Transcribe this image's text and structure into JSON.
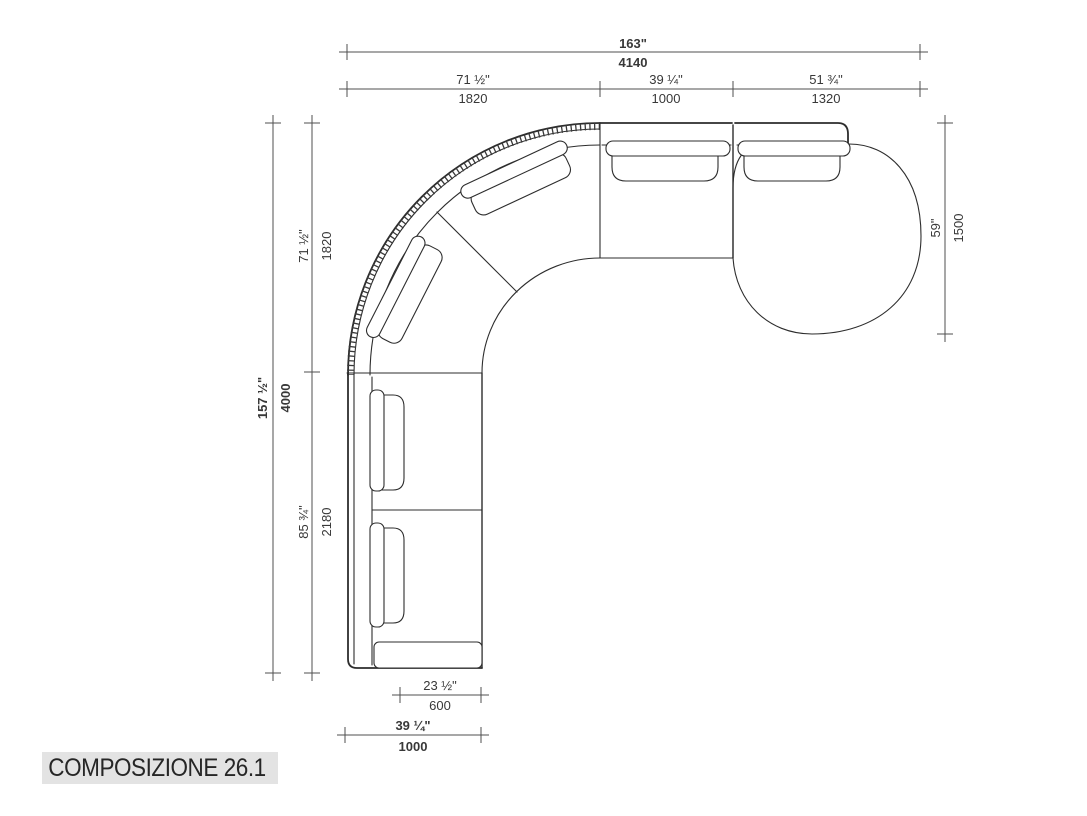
{
  "page": {
    "background": "#ffffff"
  },
  "drawing": {
    "subject": "curved modular sofa plan view",
    "line_color": "#2d2d2d",
    "dim_color": "#4f4f4f",
    "label_bg": "#e3e3e3"
  },
  "dimensions": {
    "top_overall": {
      "in": "163\"",
      "mm": "4140"
    },
    "top_segments": [
      {
        "in": "71 ½\"",
        "mm": "1820"
      },
      {
        "in": "39 ¼\"",
        "mm": "1000"
      },
      {
        "in": "51 ¾\"",
        "mm": "1320"
      }
    ],
    "left_overall": {
      "in": "157 ½\"",
      "mm": "4000"
    },
    "left_segments": [
      {
        "in": "71 ½\"",
        "mm": "1820"
      },
      {
        "in": "85 ¾\"",
        "mm": "2180"
      }
    ],
    "right_unit": {
      "in": "59\"",
      "mm": "1500"
    },
    "bottom_seat": {
      "in": "23 ½\"",
      "mm": "600"
    },
    "bottom_unit": {
      "in": "39 ¼\"",
      "mm": "1000"
    }
  },
  "footer": {
    "label": "COMPOSIZIONE 26.1"
  }
}
